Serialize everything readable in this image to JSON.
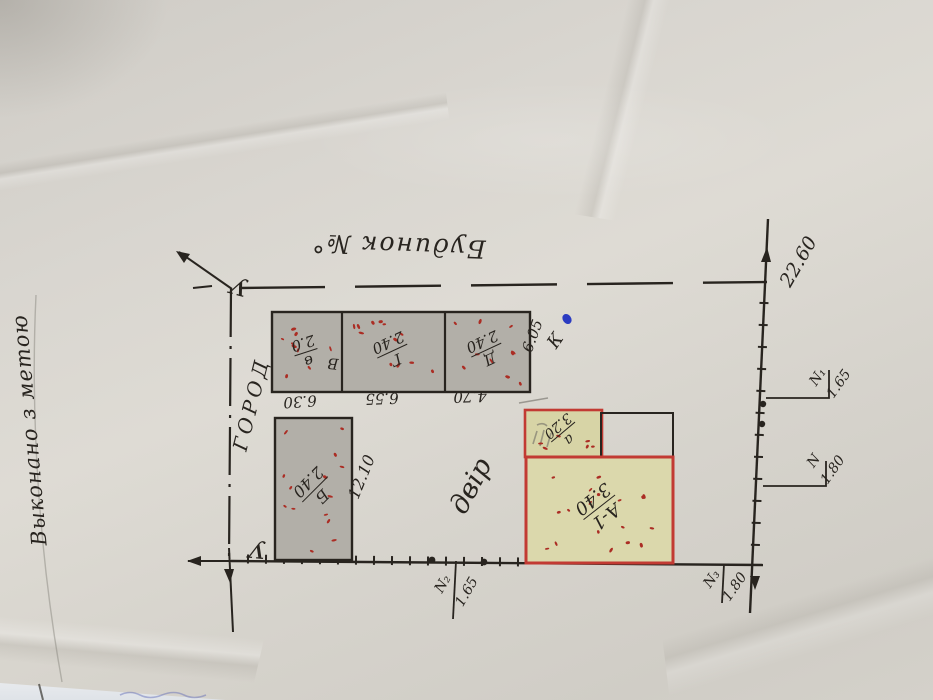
{
  "labels": {
    "margin_note": "Выконано з метою",
    "street": "Будинок №°",
    "garden": "ГОРОД",
    "yard": "двір",
    "corner_top": "У",
    "corner_bottom": "У",
    "k_mark": "К"
  },
  "buildings": {
    "v": {
      "letter": "в",
      "height": "2.0",
      "extra": "В"
    },
    "g": {
      "letter": "Г",
      "height": "2.40"
    },
    "d": {
      "letter": "Д",
      "height": "2.40"
    },
    "b": {
      "letter": "Б",
      "height": "2.40"
    },
    "a_small": {
      "letter": "а",
      "height": "3.20"
    },
    "a1": {
      "letter": "А-1",
      "height": "3.40"
    }
  },
  "dimensions": {
    "v_width": "6.30",
    "g_width": "6.55",
    "d_width": "4.70",
    "b_side": "12.10",
    "row_side": "6.05",
    "plot_side": "22.60"
  },
  "benchmarks": {
    "n1": {
      "label": "N₁",
      "value": "1.65"
    },
    "n": {
      "label": "N",
      "value": "1.80"
    },
    "n2": {
      "label": "N₂",
      "value": "1.65"
    },
    "n3": {
      "label": "N₃",
      "value": "1.80"
    }
  },
  "colors": {
    "paper": "#d6d3cc",
    "ink": "#28241f",
    "gray_fill": "#b2afa8",
    "khaki_fill": "#d7d4a6",
    "red_outline": "#c23a33",
    "red_speckle": "#ab2d24",
    "blue_mark": "#2b3bc1",
    "pencil": "#6f6c66"
  }
}
